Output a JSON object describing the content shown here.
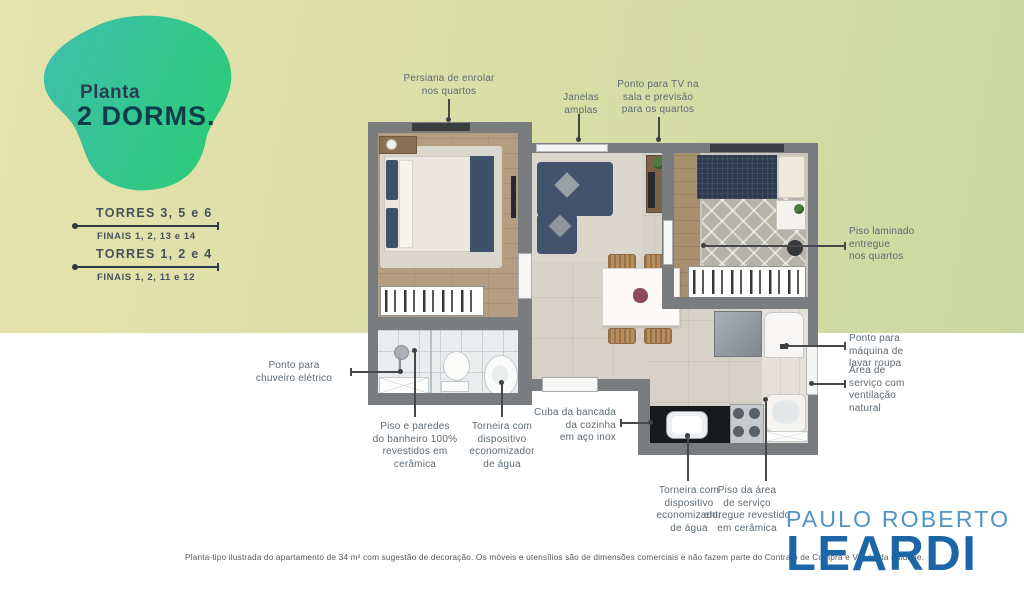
{
  "badge": {
    "line1": "Planta",
    "line2": "2 DORMS."
  },
  "towers": [
    {
      "torres": "TORRES 3, 5 e 6",
      "finais": "FINAIS 1, 2, 13 e 14"
    },
    {
      "torres": "TORRES 1, 2 e 4",
      "finais": "FINAIS 1, 2, 11 e 12"
    }
  ],
  "callouts": {
    "persiana": "Persiana de enrolar\nnos quartos",
    "janelas": "Janelas\namplas",
    "tv": "Ponto para TV na\nsala e previsão\npara os quartos",
    "piso_laminado": "Piso laminado\nentregue\nnos quartos",
    "maquina_lavar": "Ponto para\nmáquina de\nlavar roupa",
    "area_servico": "Área de\nserviço com\nventilação\nnatural",
    "chuveiro": "Ponto para\nchuveiro elétrico",
    "piso_banheiro": "Piso e paredes\ndo banheiro 100%\nrevestidos em\ncerâmica",
    "torneira_banheiro": "Torneira com\ndispositivo\neconomizador\nde água",
    "cuba": "Cuba da bancada\nda cozinha\nem aço inox",
    "torneira_cozinha": "Torneira com\ndispositivo\neconomizador\nde água",
    "piso_servico": "Piso da área\nde serviço\nentregue revestido\nem cerâmica"
  },
  "disclaimer": "Planta-tipo ilustrada do apartamento de 34 m² com sugestão de decoração. Os móveis e utensílios são de dimensões comerciais e não fazem parte do Contrato de Compra e Venda da unidade.",
  "logo": {
    "top": "PAULO ROBERTO",
    "bottom": "LEARDI"
  },
  "colors": {
    "badge_teal": "#3ec0ab",
    "badge_green": "#2dca7c",
    "band_left": "#e5e3ac",
    "band_right": "#ccd8a2",
    "logo_light_blue": "#4e94c6",
    "logo_dark_blue": "#1c66a8",
    "annotation_text": "#5d6a73",
    "wall_gray": "#797d80"
  }
}
